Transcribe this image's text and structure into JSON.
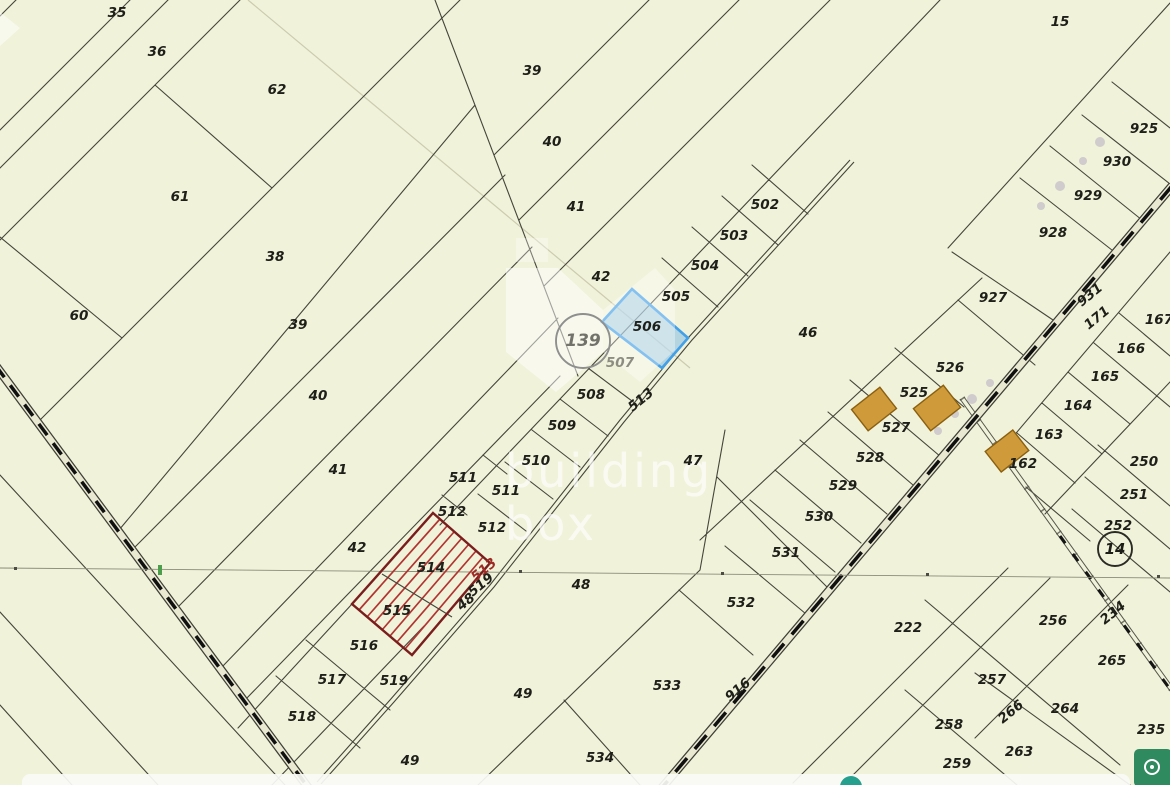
{
  "map": {
    "background": "#f1f2da",
    "boundary_color": "#45453b",
    "watermark": {
      "line1": "building",
      "line2": "box"
    },
    "selected_parcel": {
      "id": "506",
      "fill": "#77b5e4",
      "border": "#42a0e8"
    },
    "hatched_parcels": {
      "ids": "514, 515",
      "hatch_color": "#b23431",
      "border": "#7a1d1d"
    },
    "survey_tick_color": "#4c9e4c",
    "building_color": "#cf9b3a",
    "labels": [
      {
        "t": "35",
        "x": 117,
        "y": 13
      },
      {
        "t": "36",
        "x": 157,
        "y": 52
      },
      {
        "t": "62",
        "x": 277,
        "y": 90
      },
      {
        "t": "61",
        "x": 180,
        "y": 197
      },
      {
        "t": "38",
        "x": 275,
        "y": 257
      },
      {
        "t": "60",
        "x": 79,
        "y": 316
      },
      {
        "t": "39",
        "x": 298,
        "y": 325
      },
      {
        "t": "40",
        "x": 318,
        "y": 396
      },
      {
        "t": "41",
        "x": 338,
        "y": 470
      },
      {
        "t": "42",
        "x": 357,
        "y": 548
      },
      {
        "t": "39",
        "x": 532,
        "y": 71
      },
      {
        "t": "40",
        "x": 552,
        "y": 142
      },
      {
        "t": "41",
        "x": 576,
        "y": 207
      },
      {
        "t": "42",
        "x": 601,
        "y": 277
      },
      {
        "t": "502",
        "x": 765,
        "y": 205
      },
      {
        "t": "503",
        "x": 734,
        "y": 236
      },
      {
        "t": "504",
        "x": 705,
        "y": 266
      },
      {
        "t": "505",
        "x": 676,
        "y": 297
      },
      {
        "t": "506",
        "x": 647,
        "y": 327
      },
      {
        "t": "507",
        "x": 620,
        "y": 363,
        "c": "#8d8d82"
      },
      {
        "t": "508",
        "x": 591,
        "y": 395
      },
      {
        "t": "513",
        "x": 641,
        "y": 400,
        "r": -39
      },
      {
        "t": "509",
        "x": 562,
        "y": 426
      },
      {
        "t": "510",
        "x": 536,
        "y": 461
      },
      {
        "t": "511",
        "x": 463,
        "y": 478
      },
      {
        "t": "511",
        "x": 506,
        "y": 491
      },
      {
        "t": "512",
        "x": 452,
        "y": 512
      },
      {
        "t": "512",
        "x": 492,
        "y": 528
      },
      {
        "t": "46",
        "x": 808,
        "y": 333
      },
      {
        "t": "47",
        "x": 693,
        "y": 461
      },
      {
        "t": "48",
        "x": 581,
        "y": 585
      },
      {
        "t": "48",
        "x": 466,
        "y": 602,
        "r": -39
      },
      {
        "t": "514",
        "x": 431,
        "y": 568
      },
      {
        "t": "513",
        "x": 484,
        "y": 570,
        "r": -39,
        "c": "#9e2b25"
      },
      {
        "t": "519",
        "x": 481,
        "y": 585,
        "r": -39
      },
      {
        "t": "515",
        "x": 397,
        "y": 611
      },
      {
        "t": "516",
        "x": 364,
        "y": 646
      },
      {
        "t": "517",
        "x": 332,
        "y": 680
      },
      {
        "t": "519",
        "x": 394,
        "y": 681
      },
      {
        "t": "518",
        "x": 302,
        "y": 717
      },
      {
        "t": "49",
        "x": 523,
        "y": 694
      },
      {
        "t": "49",
        "x": 410,
        "y": 761
      },
      {
        "t": "534",
        "x": 600,
        "y": 758
      },
      {
        "t": "533",
        "x": 667,
        "y": 686
      },
      {
        "t": "532",
        "x": 741,
        "y": 603
      },
      {
        "t": "531",
        "x": 786,
        "y": 553
      },
      {
        "t": "916",
        "x": 738,
        "y": 690,
        "r": -39
      },
      {
        "t": "525",
        "x": 914,
        "y": 393
      },
      {
        "t": "526",
        "x": 950,
        "y": 368
      },
      {
        "t": "527",
        "x": 896,
        "y": 428
      },
      {
        "t": "528",
        "x": 870,
        "y": 458
      },
      {
        "t": "529",
        "x": 843,
        "y": 486
      },
      {
        "t": "530",
        "x": 819,
        "y": 517
      },
      {
        "t": "15",
        "x": 1060,
        "y": 22
      },
      {
        "t": "925",
        "x": 1144,
        "y": 129
      },
      {
        "t": "930",
        "x": 1117,
        "y": 162
      },
      {
        "t": "929",
        "x": 1088,
        "y": 196
      },
      {
        "t": "928",
        "x": 1053,
        "y": 233
      },
      {
        "t": "927",
        "x": 993,
        "y": 298
      },
      {
        "t": "931",
        "x": 1090,
        "y": 295,
        "r": -39
      },
      {
        "t": "171",
        "x": 1097,
        "y": 318,
        "r": -39
      },
      {
        "t": "167",
        "x": 1159,
        "y": 320
      },
      {
        "t": "166",
        "x": 1131,
        "y": 349
      },
      {
        "t": "165",
        "x": 1105,
        "y": 377
      },
      {
        "t": "164",
        "x": 1078,
        "y": 406
      },
      {
        "t": "163",
        "x": 1049,
        "y": 435
      },
      {
        "t": "162",
        "x": 1023,
        "y": 464
      },
      {
        "t": "250",
        "x": 1144,
        "y": 462
      },
      {
        "t": "251",
        "x": 1134,
        "y": 495
      },
      {
        "t": "252",
        "x": 1118,
        "y": 526
      },
      {
        "t": "222",
        "x": 908,
        "y": 628
      },
      {
        "t": "256",
        "x": 1053,
        "y": 621
      },
      {
        "t": "234",
        "x": 1113,
        "y": 613,
        "r": -39
      },
      {
        "t": "265",
        "x": 1112,
        "y": 661
      },
      {
        "t": "257",
        "x": 992,
        "y": 680
      },
      {
        "t": "266",
        "x": 1011,
        "y": 712,
        "r": -39
      },
      {
        "t": "264",
        "x": 1065,
        "y": 709
      },
      {
        "t": "258",
        "x": 949,
        "y": 725
      },
      {
        "t": "263",
        "x": 1019,
        "y": 752
      },
      {
        "t": "259",
        "x": 957,
        "y": 764
      },
      {
        "t": "235",
        "x": 1151,
        "y": 730
      }
    ],
    "markers": [
      {
        "t": "139",
        "x": 583,
        "y": 341,
        "radius": 27,
        "ring": "#8f8f8f",
        "text": "#72726a",
        "fs": 17
      },
      {
        "t": "14",
        "x": 1115,
        "y": 549,
        "radius": 17,
        "ring": "#2b2b25",
        "text": "#1d1d18",
        "fs": 15
      }
    ],
    "buildings": [
      {
        "x": 874,
        "y": 409,
        "w": 36,
        "h": 27
      },
      {
        "x": 937,
        "y": 408,
        "w": 38,
        "h": 28
      },
      {
        "x": 1007,
        "y": 451,
        "w": 35,
        "h": 26
      }
    ]
  },
  "ui": {
    "locate_button_color": "#2f8a5f",
    "bottom_bar_color": "#fbfbf7",
    "bottom_badge_color": "#26a08e"
  }
}
